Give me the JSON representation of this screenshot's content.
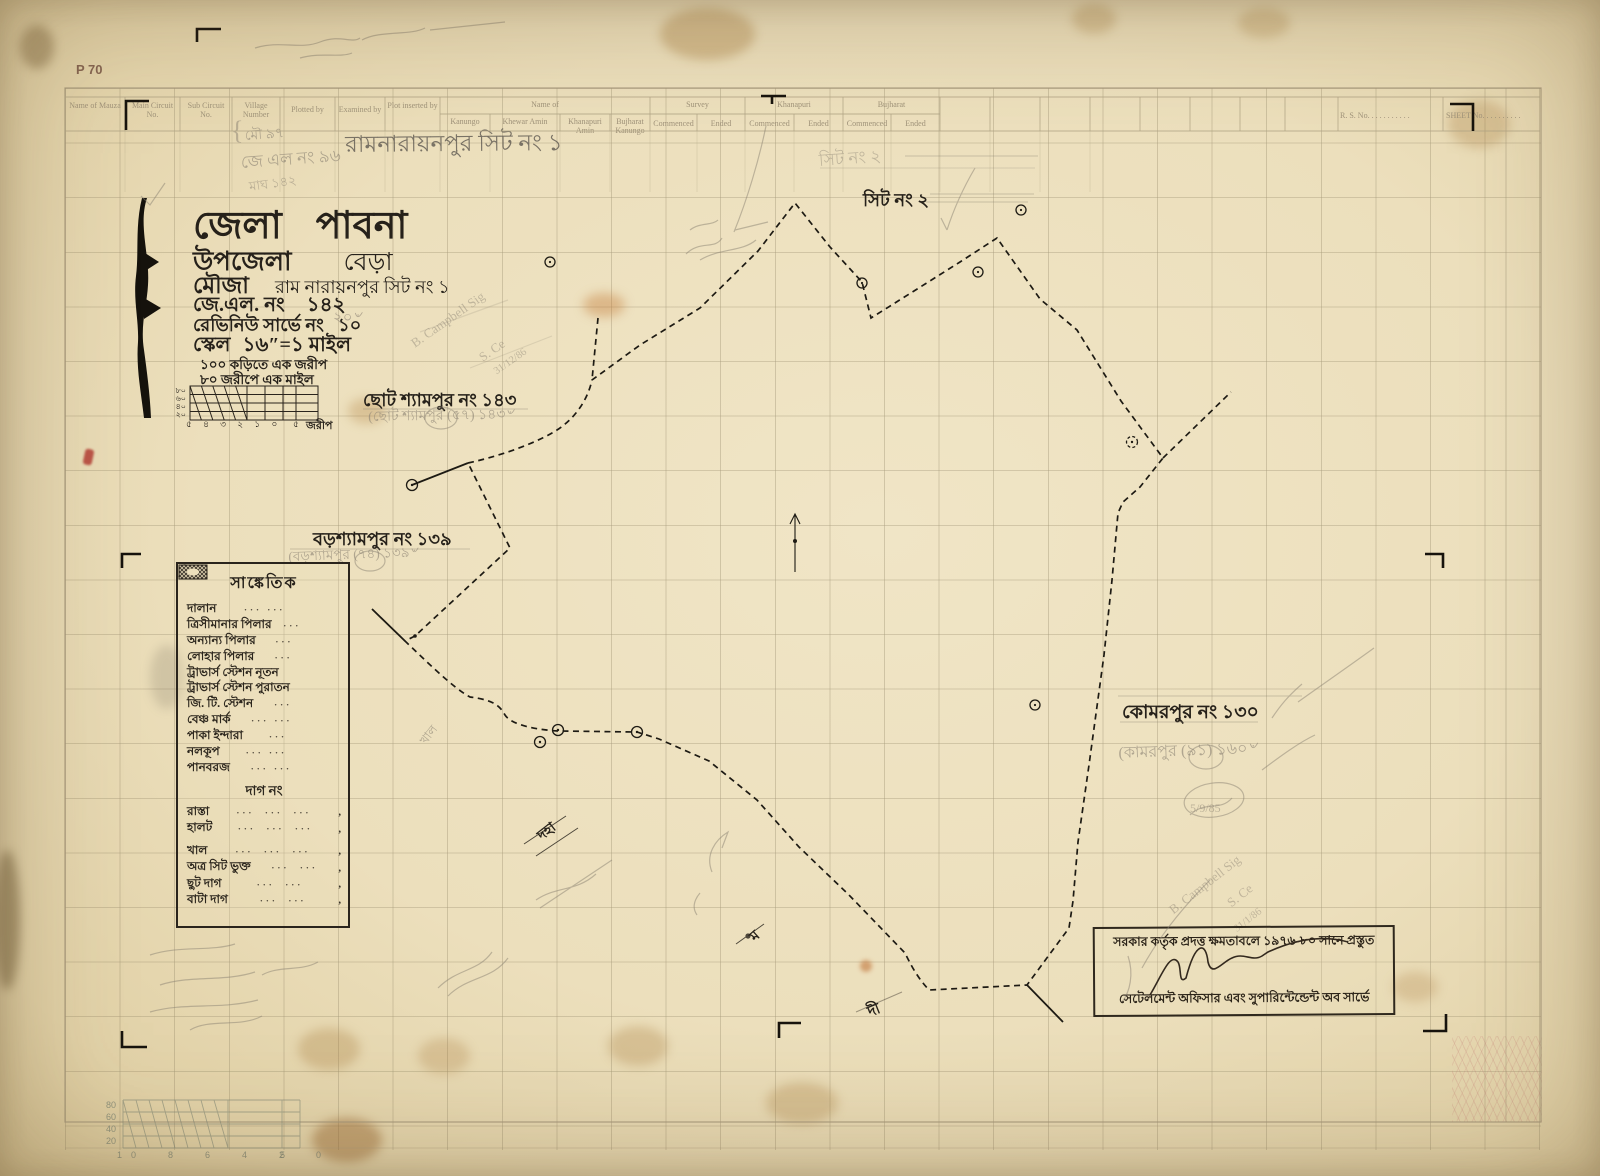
{
  "meta": {
    "corner_mark": "P 70"
  },
  "form": {
    "cols": [
      {
        "label": "Name of Mauza"
      },
      {
        "label": "Main Circuit No."
      },
      {
        "label": "Sub Circuit No."
      },
      {
        "label": "Village Number"
      },
      {
        "label": "Plotted by"
      },
      {
        "label": "Examined by"
      },
      {
        "label": "Plot inserted by"
      }
    ],
    "name_group": {
      "label": "Name of",
      "subs": [
        {
          "label": "Kanungo"
        },
        {
          "label": "Khewar Amin"
        },
        {
          "label": "Khanapuri Amin"
        },
        {
          "label": "Bujharat Kanungo"
        }
      ]
    },
    "survey_group": {
      "label": "Survey",
      "commenced": "Commenced",
      "ended": "Ended"
    },
    "khanapuri_group": {
      "label": "Khanapuri",
      "commenced": "Commenced",
      "ended": "Ended"
    },
    "bujharat_group": {
      "label": "Bujharat",
      "commenced": "Commenced",
      "ended": "Ended"
    },
    "rs_no": "R. S. No. . . . . . . . . . .",
    "sheet_no": "SHEET No. . . . . . . . . .",
    "handwritten_village": "রামনারায়নপুর সিট নং ১",
    "pencil_mou": "মৌ ৯৭",
    "pencil_jl": "জে এল নং ৯৬",
    "pencil_magh": "মাঘ ১৪২"
  },
  "title_block": {
    "district_label": "জেলা",
    "district": "পাবনা",
    "upazila_label": "উপজেলা",
    "upazila": "বেড়া",
    "mouza_label": "মৌজা",
    "mouza": "রাম নারায়নপুর সিট নং ১",
    "jl_label": "জে.এল. নং",
    "jl": "১৪২",
    "rs_label": "রেভিনিউ সার্ভে নং",
    "rs": "১০",
    "rs_pencil": "২০৺",
    "scale_label": "স্কেল",
    "scale": "১৬″=১ মাইল",
    "note1": "১০০ কড়িতে এক জরীপ",
    "note2": "৮০ জরীপে এক মাইল",
    "scalebar": {
      "left": [
        "৮০",
        "৬০",
        "৪০",
        "২০"
      ],
      "bottom": "৫ ৪ ৩ ২ ১ ০",
      "right": "৫",
      "unit": "জরীপ"
    }
  },
  "map_labels": {
    "sheet2_ink": "সিট নং ২",
    "sheet2_pencil": "সিট নং ২",
    "chhoto_ink": "ছোট শ্যামপুর নং ১৪৩",
    "chhoto_pencil": "(ছোট শ্যামপুর (৫৭) ১৪৩৺",
    "boro_ink": "বড়শ্যামপুর নং ১৩৯",
    "boro_pencil": "(বড়শ্যামপুর (৭৪) ১৩৯৺",
    "komor_ink": "কোমরপুর নং ১৩০",
    "komor_pencil": "(কামরপুর (৯১) ১৬০৺",
    "khal": "খাল",
    "doha": "দহা",
    "mo": "ম",
    "di": "দী"
  },
  "pencil_notes": {
    "campbell_a1": "B. Campbell Sig",
    "campbell_a2": "S. Ce",
    "campbell_a3": "31/12/86",
    "date_mid": "5/9/85",
    "campbell_b1": "B. Campbell Sig",
    "campbell_b2": "S. Ce",
    "campbell_b3": "31/1/86"
  },
  "legend": {
    "title": "সাঙ্কেতিক",
    "rows": [
      {
        "label": "দালান",
        "icon": "building-hatch"
      },
      {
        "label": "ত্রিসীমানার পিলার",
        "icon": "boundary-pillar"
      },
      {
        "label": "অন্যান্য পিলার",
        "icon": "other-pillar"
      },
      {
        "label": "লোহার পিলার",
        "icon": "iron-pillar"
      },
      {
        "label": "ট্রাভার্স স্টেশন নূতন",
        "icon": "traverse-station-new"
      },
      {
        "label": "ট্রাভার্স স্টেশন পুরাতন",
        "icon": "traverse-station-old"
      },
      {
        "label": "জি. টি. স্টেশন",
        "icon": "gt-station"
      },
      {
        "label": "বেঞ্চ মার্ক",
        "icon": "bench-mark"
      },
      {
        "label": "পাকা ইন্দারা",
        "icon": "masonry-well"
      },
      {
        "label": "নলকূপ",
        "icon": "tube-well"
      },
      {
        "label": "পানবরজ",
        "icon": "betel-garden"
      }
    ],
    "subheading": "দাগ নং",
    "dag_rows": [
      {
        "label": "রাস্তা"
      },
      {
        "label": "হালট"
      },
      {
        "label": "খাল"
      },
      {
        "label": "অত্র সিট ভুক্ত"
      },
      {
        "label": "ছুট দাগ"
      },
      {
        "label": "বাটা দাগ"
      }
    ]
  },
  "stamp": {
    "line1": "সরকার কর্তৃক প্রদত্ত ক্ষমতাবলে ১৯৭৬-৮০ সানে প্রস্তুত",
    "line2": "সেটেলমেন্ট অফিসার এবং সুপারিন্টেন্ডেন্ট অব সার্ভে"
  },
  "margin_scale": {
    "left": [
      "80",
      "60",
      "40",
      "20"
    ],
    "bottom": "10  8  6  4  2  0",
    "right": "5"
  },
  "colors": {
    "paper": "#ecdfbc",
    "ink": "#26211a",
    "pencil": "#8b8273",
    "print_faint": "#a2967c",
    "boundary": "#1d1a13",
    "red_mark": "#b23a2e"
  }
}
